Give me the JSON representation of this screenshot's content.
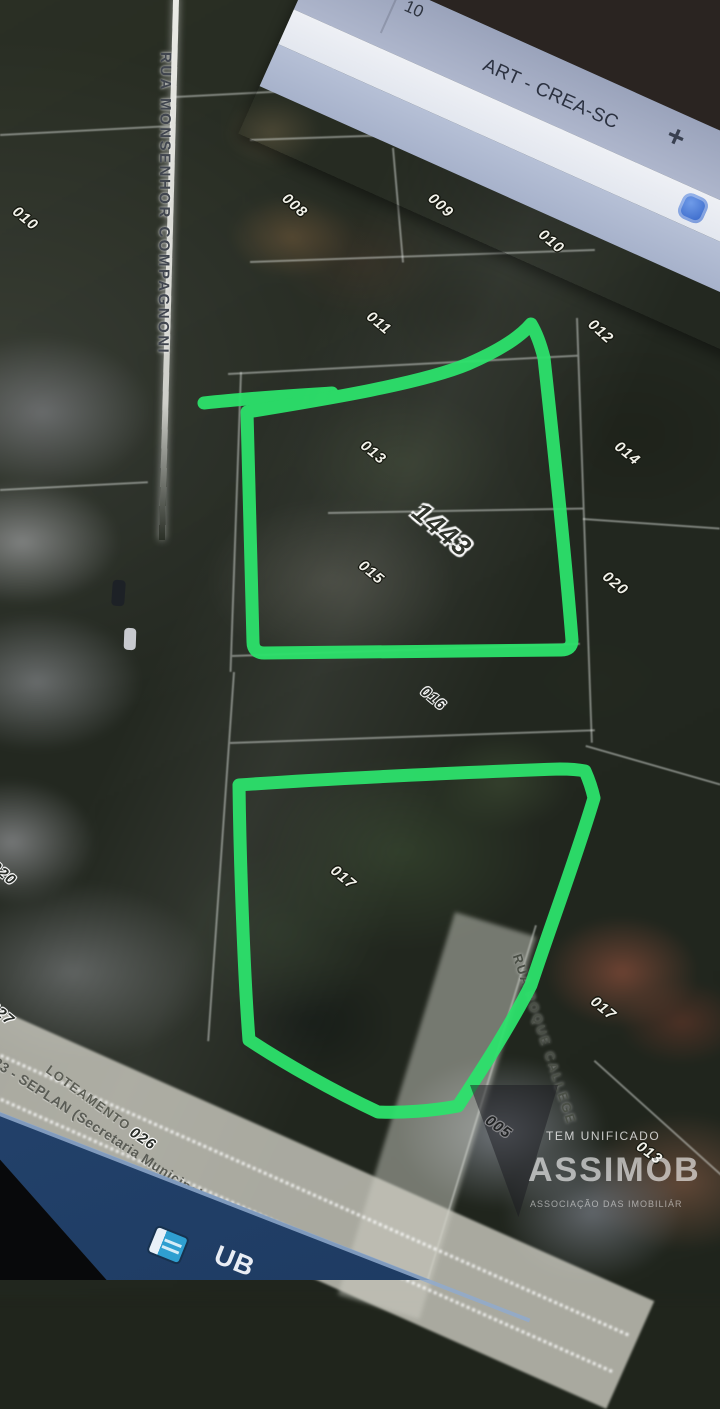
{
  "browser": {
    "partial_tab_label": "10",
    "tab_title": "ART - CREA-SC",
    "new_tab_label": "+"
  },
  "map": {
    "street_monsenhor": "RUA MONSENHOR COMPAGNONI",
    "street_roque": "RUA ROQUE CALLEGE",
    "loteamento_label": "LOTEAMENTO",
    "seplan_label": "2023 - SEPLAN (Secretaria Municipal do Plane",
    "highlight_number": "1443",
    "annotation_color": "#2ce26b",
    "lots": [
      {
        "text": "010"
      },
      {
        "text": "007"
      },
      {
        "text": "008"
      },
      {
        "text": "009"
      },
      {
        "text": "010"
      },
      {
        "text": "011"
      },
      {
        "text": "012"
      },
      {
        "text": "013"
      },
      {
        "text": "014"
      },
      {
        "text": "015"
      },
      {
        "text": "020"
      },
      {
        "text": "016"
      },
      {
        "text": "017"
      },
      {
        "text": "020"
      },
      {
        "text": "017"
      },
      {
        "text": "005"
      },
      {
        "text": "013"
      },
      {
        "text": "026"
      },
      {
        "text": "021"
      },
      {
        "text": "027"
      }
    ]
  },
  "watermark": {
    "line1": "TEM UNIFICADO",
    "line2": "ASSIMOB",
    "line3": "ASSOCIAÇÃO DAS IMOBILIÁR"
  },
  "statusbar": {
    "label": "UB"
  }
}
